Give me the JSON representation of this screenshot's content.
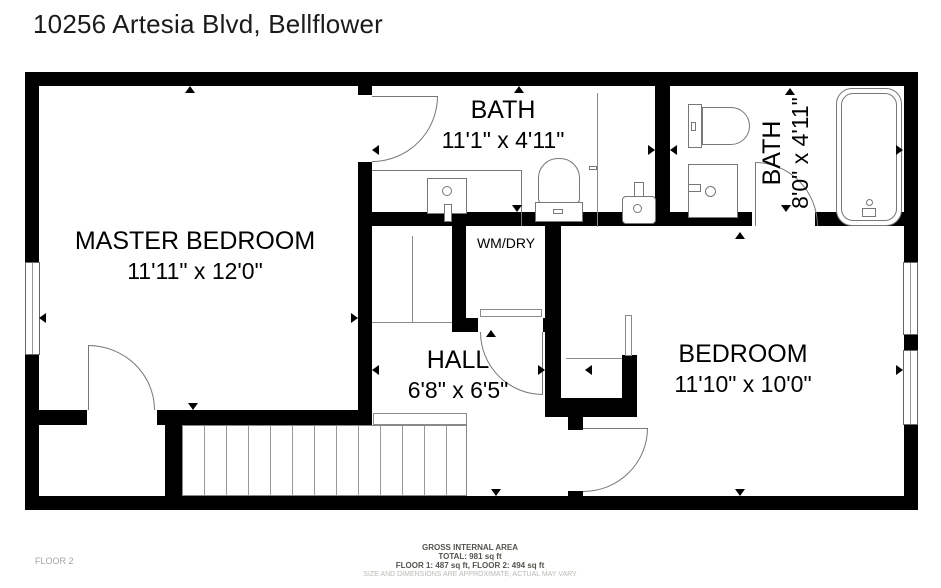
{
  "title": "10256 Artesia Blvd, Bellflower",
  "floor_label": "FLOOR 2",
  "rooms": {
    "master_bedroom": {
      "name": "MASTER BEDROOM",
      "dimensions": "11'11\" x 12'0\""
    },
    "bath_main": {
      "name": "BATH",
      "dimensions": "11'1\" x 4'11\""
    },
    "bath_ensuite": {
      "name": "BATH",
      "dimensions": "8'0\" x 4'11\""
    },
    "laundry_closet": {
      "name": "WM/DRY"
    },
    "hall": {
      "name": "HALL",
      "dimensions": "6'8\" x 6'5\""
    },
    "bedroom": {
      "name": "BEDROOM",
      "dimensions": "11'10\" x 10'0\""
    }
  },
  "footer": {
    "area_heading": "GROSS INTERNAL AREA",
    "area_total": "TOTAL: 981 sq ft",
    "area_floors": "FLOOR 1: 487 sq ft, FLOOR 2: 494 sq ft",
    "disclaimer": "SIZE AND DIMENSIONS ARE APPROXIMATE, ACTUAL MAY VARY"
  },
  "colors": {
    "wall": "#000000",
    "fixture_line": "#777777",
    "muted_text": "#a5a5a5"
  }
}
